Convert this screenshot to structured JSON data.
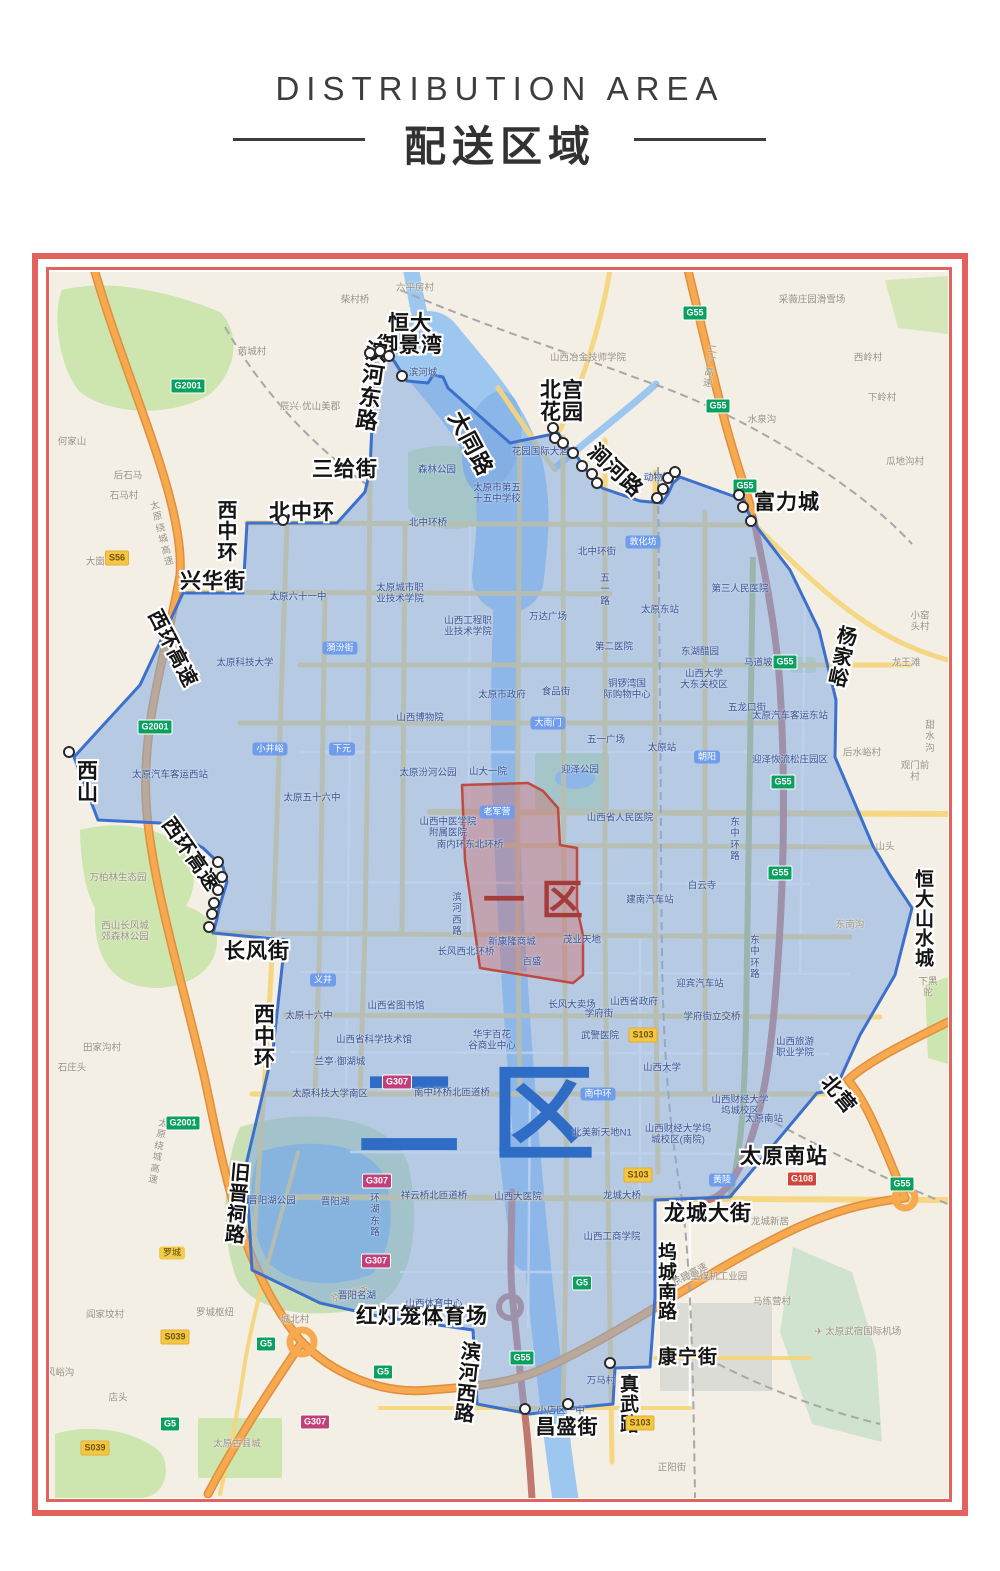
{
  "header": {
    "title_en": "DISTRIBUTION AREA",
    "title_zh": "配送区域"
  },
  "zones": {
    "zone1": {
      "label": "一区",
      "color": "#a63c39"
    },
    "zone2": {
      "label": "二区",
      "color": "#2f6cc6"
    }
  },
  "map": {
    "street_labels": [
      {
        "t": "恒大\n御景湾",
        "x": 360,
        "y": 63,
        "fs": 21
      },
      {
        "t": "滨\n河\n东\n路",
        "x": 322,
        "y": 115,
        "fs": 22,
        "rot": 8
      },
      {
        "t": "大同路",
        "x": 420,
        "y": 172,
        "fs": 22,
        "rot": 62
      },
      {
        "t": "北宫\n花园",
        "x": 512,
        "y": 130,
        "fs": 21
      },
      {
        "t": "涧河路",
        "x": 565,
        "y": 199,
        "fs": 21,
        "rot": 43
      },
      {
        "t": "富力城",
        "x": 737,
        "y": 231,
        "fs": 21
      },
      {
        "t": "三给街",
        "x": 295,
        "y": 198,
        "fs": 21
      },
      {
        "t": "北中环",
        "x": 252,
        "y": 241,
        "fs": 21
      },
      {
        "t": "西\n中\n环",
        "x": 178,
        "y": 260,
        "fs": 20
      },
      {
        "t": "兴华街",
        "x": 163,
        "y": 310,
        "fs": 21
      },
      {
        "t": "西环高速",
        "x": 122,
        "y": 377,
        "fs": 20,
        "rot": 63
      },
      {
        "t": "西\n山",
        "x": 38,
        "y": 511,
        "fs": 21
      },
      {
        "t": "西环高速",
        "x": 140,
        "y": 583,
        "fs": 20,
        "rot": 55
      },
      {
        "t": "长风街",
        "x": 207,
        "y": 680,
        "fs": 21
      },
      {
        "t": "西\n中\n环",
        "x": 215,
        "y": 765,
        "fs": 21
      },
      {
        "t": "旧\n晋\n祠\n路",
        "x": 188,
        "y": 933,
        "fs": 20,
        "rot": 5
      },
      {
        "t": "红灯笼体育场",
        "x": 372,
        "y": 1045,
        "fs": 21
      },
      {
        "t": "滨\n河\n西\n路",
        "x": 418,
        "y": 1112,
        "fs": 20,
        "rot": 6
      },
      {
        "t": "昌盛街",
        "x": 517,
        "y": 1156,
        "fs": 20
      },
      {
        "t": "真\n武\n路",
        "x": 580,
        "y": 1133,
        "fs": 19
      },
      {
        "t": "康宁街",
        "x": 638,
        "y": 1086,
        "fs": 19
      },
      {
        "t": "坞\n城\n南\n路",
        "x": 618,
        "y": 1011,
        "fs": 19
      },
      {
        "t": "龙城大街",
        "x": 658,
        "y": 942,
        "fs": 21
      },
      {
        "t": "太原南站",
        "x": 734,
        "y": 885,
        "fs": 21
      },
      {
        "t": "北营",
        "x": 788,
        "y": 823,
        "fs": 20,
        "rot": 50
      },
      {
        "t": "杨\n家\n峪",
        "x": 793,
        "y": 386,
        "fs": 20,
        "rot": 12
      },
      {
        "t": "恒\n大\n山\n水\n城",
        "x": 875,
        "y": 648,
        "fs": 19
      }
    ],
    "poi_labels": [
      {
        "t": "柴村桥",
        "x": 305,
        "y": 28,
        "k": "out"
      },
      {
        "t": "六平房村",
        "x": 365,
        "y": 16,
        "k": "out"
      },
      {
        "t": "采薇庄园滑雪场",
        "x": 762,
        "y": 28,
        "k": "out"
      },
      {
        "t": "西岭村",
        "x": 818,
        "y": 86,
        "k": "out"
      },
      {
        "t": "下岭村",
        "x": 832,
        "y": 126,
        "k": "out"
      },
      {
        "t": "水泉沟",
        "x": 712,
        "y": 148,
        "k": "out"
      },
      {
        "t": "瓜地沟村",
        "x": 855,
        "y": 190,
        "k": "out"
      },
      {
        "t": "芮城村",
        "x": 202,
        "y": 80,
        "k": "out"
      },
      {
        "t": "辰兴·优山美郡",
        "x": 260,
        "y": 135,
        "k": "out"
      },
      {
        "t": "山西冶金技师学院",
        "x": 538,
        "y": 86,
        "k": "out"
      },
      {
        "t": "何家山",
        "x": 22,
        "y": 170,
        "k": "out"
      },
      {
        "t": "后石马",
        "x": 78,
        "y": 204,
        "k": "out"
      },
      {
        "t": "石马村",
        "x": 74,
        "y": 224,
        "k": "out"
      },
      {
        "t": "大崮村",
        "x": 50,
        "y": 290,
        "k": "out"
      },
      {
        "t": "小窑头村",
        "x": 870,
        "y": 350,
        "k": "out"
      },
      {
        "t": "龙王滩",
        "x": 856,
        "y": 391,
        "k": "out"
      },
      {
        "t": "甜水沟",
        "x": 880,
        "y": 465,
        "k": "out"
      },
      {
        "t": "后水峪村",
        "x": 812,
        "y": 481,
        "k": "out"
      },
      {
        "t": "观门前村",
        "x": 865,
        "y": 500,
        "k": "out"
      },
      {
        "t": "山头",
        "x": 835,
        "y": 575,
        "k": "out"
      },
      {
        "t": "东南沟",
        "x": 800,
        "y": 653,
        "k": "out"
      },
      {
        "t": "下黑驼",
        "x": 878,
        "y": 716,
        "k": "out"
      },
      {
        "t": "万柏林生态园",
        "x": 68,
        "y": 606,
        "k": "out"
      },
      {
        "t": "西山长风城\n郊森林公园",
        "x": 75,
        "y": 660,
        "k": "out"
      },
      {
        "t": "田家沟村",
        "x": 52,
        "y": 776,
        "k": "out"
      },
      {
        "t": "石庄头",
        "x": 22,
        "y": 796,
        "k": "out"
      },
      {
        "t": "罗城枢纽",
        "x": 165,
        "y": 1041,
        "k": "out"
      },
      {
        "t": "城北村",
        "x": 245,
        "y": 1048,
        "k": "out"
      },
      {
        "t": "阎家坟村",
        "x": 55,
        "y": 1043,
        "k": "out"
      },
      {
        "t": "店头",
        "x": 68,
        "y": 1126,
        "k": "out"
      },
      {
        "t": "风峪沟",
        "x": 10,
        "y": 1101,
        "k": "out"
      },
      {
        "t": "太原古县城",
        "x": 187,
        "y": 1172,
        "k": "out"
      },
      {
        "t": "正阳街",
        "x": 622,
        "y": 1196,
        "k": "out"
      },
      {
        "t": "马练营村",
        "x": 722,
        "y": 1030,
        "k": "out"
      },
      {
        "t": "✈ 太原武宿国际机场",
        "x": 808,
        "y": 1060,
        "k": "out"
      },
      {
        "t": "太重煤机工业园",
        "x": 664,
        "y": 1005,
        "k": "out"
      },
      {
        "t": "龙城新居",
        "x": 720,
        "y": 950,
        "k": "out"
      },
      {
        "t": "京昆高速",
        "x": 300,
        "y": 1023,
        "k": "out",
        "rot": -14
      },
      {
        "t": "京昆高速",
        "x": 640,
        "y": 1003,
        "k": "out",
        "rot": -28
      },
      {
        "t": "太\n原\n绕\n城\n高\n速",
        "x": 112,
        "y": 262,
        "k": "out",
        "rot": -14
      },
      {
        "t": "太\n原\n绕\n城\n高\n速",
        "x": 108,
        "y": 880,
        "k": "out",
        "rot": 10
      },
      {
        "t": "二\n广\n高\n速",
        "x": 660,
        "y": 95,
        "k": "out",
        "rot": 8
      },
      {
        "t": "滨河城",
        "x": 373,
        "y": 101,
        "k": "in"
      },
      {
        "t": "森林公园",
        "x": 387,
        "y": 198,
        "k": "in"
      },
      {
        "t": "太原市第五\n十五中学校",
        "x": 447,
        "y": 222,
        "k": "in"
      },
      {
        "t": "北中环桥",
        "x": 378,
        "y": 251,
        "k": "in"
      },
      {
        "t": "北中环街",
        "x": 547,
        "y": 280,
        "k": "in"
      },
      {
        "t": "花园国际大酒店",
        "x": 495,
        "y": 180,
        "k": "in"
      },
      {
        "t": "动物园",
        "x": 608,
        "y": 206,
        "k": "in"
      },
      {
        "t": "太原六十一中",
        "x": 248,
        "y": 325,
        "k": "in"
      },
      {
        "t": "太原城市职\n业技术学院",
        "x": 350,
        "y": 322,
        "k": "in"
      },
      {
        "t": "太原科技大学",
        "x": 195,
        "y": 391,
        "k": "in"
      },
      {
        "t": "山西工程职\n业技术学院",
        "x": 418,
        "y": 355,
        "k": "in"
      },
      {
        "t": "万达广场",
        "x": 498,
        "y": 345,
        "k": "in"
      },
      {
        "t": "太原东站",
        "x": 610,
        "y": 338,
        "k": "in"
      },
      {
        "t": "第三人民医院",
        "x": 690,
        "y": 317,
        "k": "in"
      },
      {
        "t": "马道坡街",
        "x": 713,
        "y": 391,
        "k": "in"
      },
      {
        "t": "东湖醋园",
        "x": 650,
        "y": 380,
        "k": "in"
      },
      {
        "t": "山西大学\n大东关校区",
        "x": 654,
        "y": 408,
        "k": "in"
      },
      {
        "t": "第二医院",
        "x": 564,
        "y": 375,
        "k": "in"
      },
      {
        "t": "太原市政府",
        "x": 452,
        "y": 423,
        "k": "in"
      },
      {
        "t": "食品街",
        "x": 506,
        "y": 420,
        "k": "in"
      },
      {
        "t": "铜锣湾国\n际购物中心",
        "x": 577,
        "y": 418,
        "k": "in"
      },
      {
        "t": "五龙口街",
        "x": 697,
        "y": 436,
        "k": "in"
      },
      {
        "t": "太原汽车客运东站",
        "x": 740,
        "y": 444,
        "k": "in"
      },
      {
        "t": "五一广场",
        "x": 556,
        "y": 468,
        "k": "in"
      },
      {
        "t": "太原站",
        "x": 612,
        "y": 476,
        "k": "in"
      },
      {
        "t": "五\n一\n路",
        "x": 555,
        "y": 318,
        "k": "in"
      },
      {
        "t": "山西博物院",
        "x": 370,
        "y": 446,
        "k": "in"
      },
      {
        "t": "太原汽车客运西站",
        "x": 120,
        "y": 503,
        "k": "in"
      },
      {
        "t": "太原五十六中",
        "x": 262,
        "y": 526,
        "k": "in"
      },
      {
        "t": "太原汾河公园",
        "x": 378,
        "y": 501,
        "k": "in"
      },
      {
        "t": "山大一院",
        "x": 438,
        "y": 500,
        "k": "in"
      },
      {
        "t": "迎泽公园",
        "x": 530,
        "y": 498,
        "k": "in"
      },
      {
        "t": "山西省人民医院",
        "x": 570,
        "y": 546,
        "k": "in"
      },
      {
        "t": "山西中医学院\n附属医院",
        "x": 398,
        "y": 556,
        "k": "in"
      },
      {
        "t": "南内环东北环桥",
        "x": 420,
        "y": 573,
        "k": "in"
      },
      {
        "t": "白云寺",
        "x": 652,
        "y": 614,
        "k": "in"
      },
      {
        "t": "建南汽车站",
        "x": 600,
        "y": 628,
        "k": "in"
      },
      {
        "t": "迎泽恢流松庄园区",
        "x": 740,
        "y": 488,
        "k": "in"
      },
      {
        "t": "东\n中\n环\n路",
        "x": 685,
        "y": 568,
        "k": "in"
      },
      {
        "t": "东\n中\n环\n路",
        "x": 705,
        "y": 686,
        "k": "in"
      },
      {
        "t": "新康隆商城",
        "x": 462,
        "y": 670,
        "k": "in"
      },
      {
        "t": "茂业天地",
        "x": 532,
        "y": 668,
        "k": "in"
      },
      {
        "t": "百盛",
        "x": 482,
        "y": 690,
        "k": "in"
      },
      {
        "t": "滨\n河\n西\n路",
        "x": 407,
        "y": 643,
        "k": "in"
      },
      {
        "t": "长风西北环桥",
        "x": 416,
        "y": 680,
        "k": "in"
      },
      {
        "t": "长风大卖场",
        "x": 522,
        "y": 733,
        "k": "in"
      },
      {
        "t": "山西省政府",
        "x": 584,
        "y": 730,
        "k": "in"
      },
      {
        "t": "迎宾汽车站",
        "x": 650,
        "y": 712,
        "k": "in"
      },
      {
        "t": "学府街",
        "x": 549,
        "y": 742,
        "k": "in"
      },
      {
        "t": "学府街立交桥",
        "x": 662,
        "y": 745,
        "k": "in"
      },
      {
        "t": "武警医院",
        "x": 550,
        "y": 764,
        "k": "in"
      },
      {
        "t": "山西大学",
        "x": 612,
        "y": 796,
        "k": "in"
      },
      {
        "t": "山西省图书馆",
        "x": 346,
        "y": 734,
        "k": "in"
      },
      {
        "t": "太原十六中",
        "x": 259,
        "y": 744,
        "k": "in"
      },
      {
        "t": "山西省科学技术馆",
        "x": 324,
        "y": 768,
        "k": "in"
      },
      {
        "t": "华宇百花\n谷商业中心",
        "x": 442,
        "y": 769,
        "k": "in"
      },
      {
        "t": "兰亭·御湖城",
        "x": 290,
        "y": 790,
        "k": "in"
      },
      {
        "t": "太原科技大学南区",
        "x": 280,
        "y": 822,
        "k": "in"
      },
      {
        "t": "山西旅游\n职业学院",
        "x": 745,
        "y": 776,
        "k": "in"
      },
      {
        "t": "山西财经大学\n坞城校区",
        "x": 690,
        "y": 834,
        "k": "in"
      },
      {
        "t": "北美新天地N1",
        "x": 552,
        "y": 861,
        "k": "in"
      },
      {
        "t": "山西财经大学坞\n城校区(南院)",
        "x": 628,
        "y": 863,
        "k": "in"
      },
      {
        "t": "南中环桥北匝道桥",
        "x": 402,
        "y": 821,
        "k": "in"
      },
      {
        "t": "祥云桥北匝道桥",
        "x": 384,
        "y": 924,
        "k": "in"
      },
      {
        "t": "山西大医院",
        "x": 468,
        "y": 925,
        "k": "in"
      },
      {
        "t": "龙城大桥",
        "x": 572,
        "y": 924,
        "k": "in"
      },
      {
        "t": "山西工商学院",
        "x": 562,
        "y": 965,
        "k": "in"
      },
      {
        "t": "晋阳湖公园",
        "x": 222,
        "y": 929,
        "k": "in"
      },
      {
        "t": "晋阳湖",
        "x": 285,
        "y": 930,
        "k": "in"
      },
      {
        "t": "环\n湖\n东\n路",
        "x": 325,
        "y": 944,
        "k": "in"
      },
      {
        "t": "晋阳名湖",
        "x": 307,
        "y": 1024,
        "k": "in"
      },
      {
        "t": "山西体育中心",
        "x": 384,
        "y": 1032,
        "k": "in"
      },
      {
        "t": "万马村",
        "x": 551,
        "y": 1109,
        "k": "in"
      },
      {
        "t": "小店区一中",
        "x": 511,
        "y": 1139,
        "k": "in"
      },
      {
        "t": "太原南站",
        "x": 714,
        "y": 847,
        "k": "in"
      }
    ],
    "pills": [
      {
        "t": "敦化坊",
        "x": 593,
        "y": 270,
        "k": "blue"
      },
      {
        "t": "小井峪",
        "x": 220,
        "y": 477,
        "k": "blue"
      },
      {
        "t": "下元",
        "x": 292,
        "y": 477,
        "k": "blue"
      },
      {
        "t": "朝阳",
        "x": 657,
        "y": 485,
        "k": "blue"
      },
      {
        "t": "老军营",
        "x": 447,
        "y": 540,
        "k": "blue"
      },
      {
        "t": "大南门",
        "x": 498,
        "y": 451,
        "k": "blue"
      },
      {
        "t": "漪汾街",
        "x": 290,
        "y": 376,
        "k": "blue"
      },
      {
        "t": "义井",
        "x": 273,
        "y": 708,
        "k": "blue"
      },
      {
        "t": "南中环",
        "x": 548,
        "y": 822,
        "k": "blue"
      },
      {
        "t": "黄陵",
        "x": 672,
        "y": 908,
        "k": "blue"
      },
      {
        "t": "罗城",
        "x": 122,
        "y": 981,
        "k": "yellow"
      }
    ],
    "shields": [
      {
        "t": "G55",
        "x": 645,
        "y": 41,
        "k": "green"
      },
      {
        "t": "G55",
        "x": 668,
        "y": 134,
        "k": "green"
      },
      {
        "t": "G55",
        "x": 695,
        "y": 214,
        "k": "green"
      },
      {
        "t": "G55",
        "x": 735,
        "y": 390,
        "k": "green"
      },
      {
        "t": "G55",
        "x": 733,
        "y": 510,
        "k": "green"
      },
      {
        "t": "G55",
        "x": 730,
        "y": 601,
        "k": "green"
      },
      {
        "t": "G55",
        "x": 852,
        "y": 912,
        "k": "green"
      },
      {
        "t": "G55",
        "x": 472,
        "y": 1086,
        "k": "green"
      },
      {
        "t": "G5",
        "x": 333,
        "y": 1100,
        "k": "green"
      },
      {
        "t": "G5",
        "x": 216,
        "y": 1072,
        "k": "green"
      },
      {
        "t": "G5",
        "x": 120,
        "y": 1152,
        "k": "green"
      },
      {
        "t": "G5",
        "x": 532,
        "y": 1011,
        "k": "green"
      },
      {
        "t": "G2001",
        "x": 138,
        "y": 114,
        "k": "green"
      },
      {
        "t": "G2001",
        "x": 105,
        "y": 455,
        "k": "green"
      },
      {
        "t": "G2001",
        "x": 133,
        "y": 851,
        "k": "green"
      },
      {
        "t": "G307",
        "x": 347,
        "y": 810,
        "k": "magenta"
      },
      {
        "t": "G307",
        "x": 327,
        "y": 909,
        "k": "magenta"
      },
      {
        "t": "G307",
        "x": 326,
        "y": 989,
        "k": "magenta"
      },
      {
        "t": "G307",
        "x": 265,
        "y": 1150,
        "k": "magenta"
      },
      {
        "t": "G108",
        "x": 752,
        "y": 907,
        "k": "red"
      },
      {
        "t": "S103",
        "x": 593,
        "y": 763,
        "k": "yellow"
      },
      {
        "t": "S103",
        "x": 588,
        "y": 903,
        "k": "yellow"
      },
      {
        "t": "S103",
        "x": 590,
        "y": 1151,
        "k": "yellow"
      },
      {
        "t": "S56",
        "x": 67,
        "y": 286,
        "k": "yellow"
      },
      {
        "t": "S039",
        "x": 125,
        "y": 1065,
        "k": "yellow"
      },
      {
        "t": "S039",
        "x": 45,
        "y": 1176,
        "k": "yellow"
      }
    ],
    "dots": [
      [
        325,
        86
      ],
      [
        335,
        84
      ],
      [
        344,
        89
      ],
      [
        357,
        109
      ],
      [
        508,
        161
      ],
      [
        510,
        171
      ],
      [
        518,
        176
      ],
      [
        528,
        186
      ],
      [
        537,
        199
      ],
      [
        547,
        207
      ],
      [
        552,
        216
      ],
      [
        612,
        231
      ],
      [
        618,
        222
      ],
      [
        623,
        211
      ],
      [
        630,
        205
      ],
      [
        694,
        228
      ],
      [
        698,
        240
      ],
      [
        706,
        254
      ],
      [
        238,
        253
      ],
      [
        173,
        595
      ],
      [
        177,
        610
      ],
      [
        173,
        623
      ],
      [
        169,
        636
      ],
      [
        167,
        647
      ],
      [
        164,
        660
      ],
      [
        24,
        485
      ],
      [
        480,
        1142
      ],
      [
        523,
        1137
      ],
      [
        565,
        1096
      ]
    ]
  }
}
